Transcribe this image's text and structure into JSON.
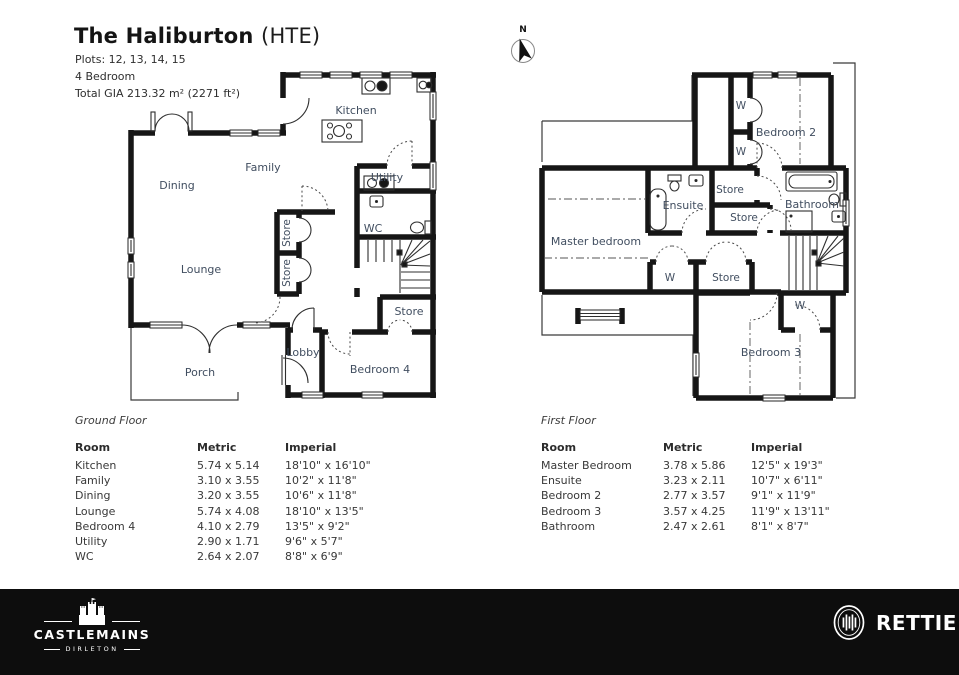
{
  "header": {
    "title": "The Haliburton",
    "title_suffix": "(HTE)",
    "plots": "Plots: 12, 13, 14, 15",
    "bedrooms": "4 Bedroom",
    "gia": "Total GIA 213.32 m² (2271 ft²)"
  },
  "compass": {
    "label": "N"
  },
  "plans": {
    "ground": {
      "labels": {
        "kitchen": "Kitchen",
        "family": "Family",
        "dining": "Dining",
        "lounge": "Lounge",
        "utility": "Utility",
        "wc": "WC",
        "store_hall_top": "Store",
        "store_hall_bottom": "Store",
        "store_br": "Store",
        "lobby": "Lobby",
        "bedroom4": "Bedroom 4",
        "porch": "Porch"
      }
    },
    "first": {
      "labels": {
        "master": "Master bedroom",
        "bedroom2": "Bedroom 2",
        "bedroom3": "Bedroom 3",
        "ensuite": "Ensuite",
        "bathroom": "Bathroom",
        "store_upper": "Store",
        "store_lower": "Store",
        "store_master": "Store",
        "w1": "W",
        "w2": "W",
        "w_master": "W",
        "w_bed3": "W"
      }
    }
  },
  "tables": {
    "ground": {
      "caption": "Ground Floor",
      "headers": [
        "Room",
        "Metric",
        "Imperial"
      ],
      "rows": [
        [
          "Kitchen",
          "5.74 x 5.14",
          "18'10\" x 16'10\""
        ],
        [
          "Family",
          "3.10 x 3.55",
          "10'2\" x 11'8\""
        ],
        [
          "Dining",
          "3.20 x 3.55",
          "10'6\" x 11'8\""
        ],
        [
          "Lounge",
          "5.74 x 4.08",
          "18'10\" x 13'5\""
        ],
        [
          "Bedroom 4",
          "4.10 x 2.79",
          "13'5\" x 9'2\""
        ],
        [
          "Utility",
          "2.90 x 1.71",
          "9'6\" x 5'7\""
        ],
        [
          "WC",
          "2.64 x 2.07",
          "8'8\" x 6'9\""
        ]
      ]
    },
    "first": {
      "caption": "First Floor",
      "headers": [
        "Room",
        "Metric",
        "Imperial"
      ],
      "rows": [
        [
          "Master Bedroom",
          "3.78 x 5.86",
          "12'5\" x 19'3\""
        ],
        [
          "Ensuite",
          "3.23 x 2.11",
          "10'7\" x 6'11\""
        ],
        [
          "Bedroom 2",
          "2.77 x 3.57",
          "9'1\" x 11'9\""
        ],
        [
          "Bedroom 3",
          "3.57 x 4.25",
          "11'9\" x 13'11\""
        ],
        [
          "Bathroom",
          "2.47 x 2.61",
          "8'1\" x 8'7\""
        ]
      ]
    }
  },
  "footer": {
    "brand_left": {
      "name": "CASTLEMAINS",
      "sub": "DIRLETON"
    },
    "brand_right": {
      "name": "RETTIE"
    }
  }
}
